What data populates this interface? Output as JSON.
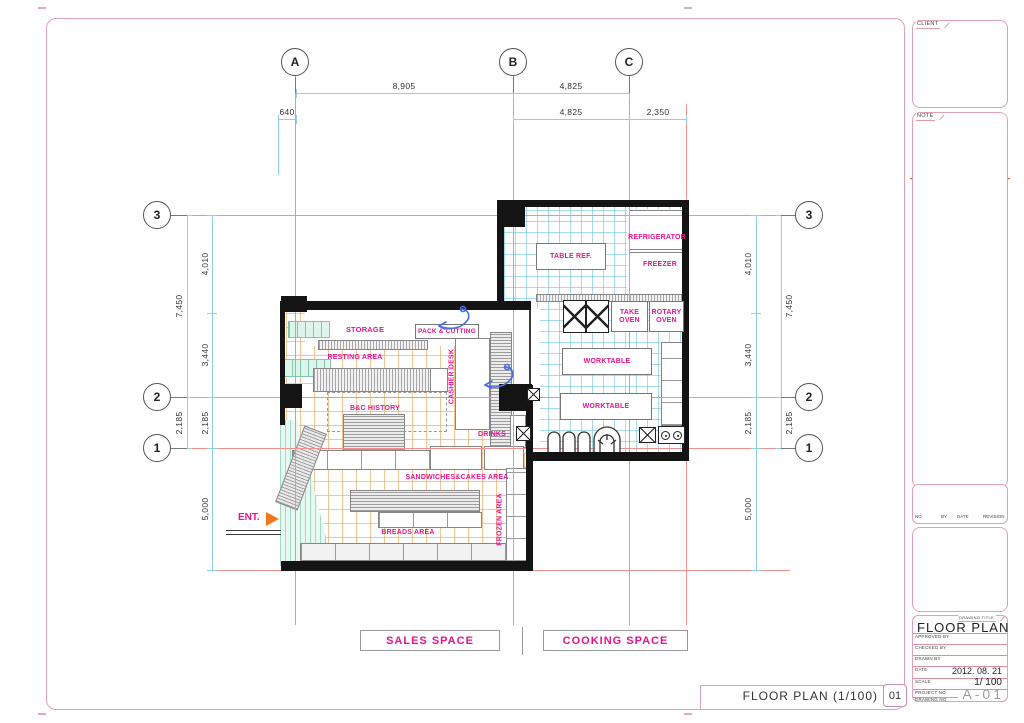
{
  "grid": {
    "cols": [
      "A",
      "B",
      "C"
    ],
    "rows": [
      "3",
      "2",
      "1"
    ]
  },
  "dimensions": {
    "top_primary": [
      "8,905",
      "4,825"
    ],
    "top_secondary": [
      "640",
      "4,825",
      "2,350"
    ],
    "side_outer": [
      "7,450",
      "2,185"
    ],
    "side_inner": [
      "4,010",
      "3,440",
      "2,185",
      "5,000"
    ]
  },
  "rooms": {
    "storage": "STORAGE",
    "pack_cutting": "PACK & CUTTING",
    "resting": "RESTING AREA",
    "history": "B&C HISTORY",
    "cashier": "CASHIER DESK",
    "drinks": "DRINKS",
    "sandwiches": "SANDWICHES&CAKES AREA",
    "frozen": "FROZEN AREA",
    "breads": "BREADS AREA",
    "entrance": "ENT.",
    "table_ref": "TABLE REF.",
    "refrigerator": "REFRIGERATOR",
    "freezer": "FREEZER",
    "take_oven": "TAKE OVEN",
    "rotary_oven": "ROTARY OVEN",
    "worktable_1": "WORKTABLE",
    "worktable_2": "WORKTABLE"
  },
  "legend": {
    "sales": "SALES SPACE",
    "cooking": "COOKING SPACE"
  },
  "footer": {
    "drawing_title": "FLOOR PLAN (1/100)",
    "sheet_no": "01"
  },
  "panel": {
    "client": {
      "tab": "CLIENT",
      "name": "B&C",
      "branch": "롯데백화점 동래점"
    },
    "note": {
      "tab": "NOTE",
      "logo_the": "The",
      "logo_main": "B&C",
      "logo_sub": "Bread and Cakes",
      "logo_since": "— Since 1983 —"
    },
    "revision": {
      "headers": [
        "NO",
        "BY",
        "DATE",
        "REVISION"
      ]
    },
    "company": {
      "logo": "B&C",
      "line1": "Design",
      "line2": "Communication",
      "line3": "Group"
    },
    "titleblock": {
      "tab": "DRAWING TITLE",
      "title": "FLOOR PLAN",
      "rows": [
        {
          "label": "APPROVED BY",
          "value": ""
        },
        {
          "label": "CHECKED BY",
          "value": ""
        },
        {
          "label": "DRAWN BY",
          "value": ""
        },
        {
          "label": "DATE",
          "value": "2012. 08. 21"
        },
        {
          "label": "SCALE",
          "value": "1/ 100"
        },
        {
          "label": "PROJECT NO",
          "value": ""
        },
        {
          "label": "DRAWING NO",
          "value": "A-01"
        }
      ]
    }
  },
  "colors": {
    "label_magenta": "#e8138e",
    "logo_orange": "#e8481c",
    "frame_pink": "#dfa3b2"
  }
}
